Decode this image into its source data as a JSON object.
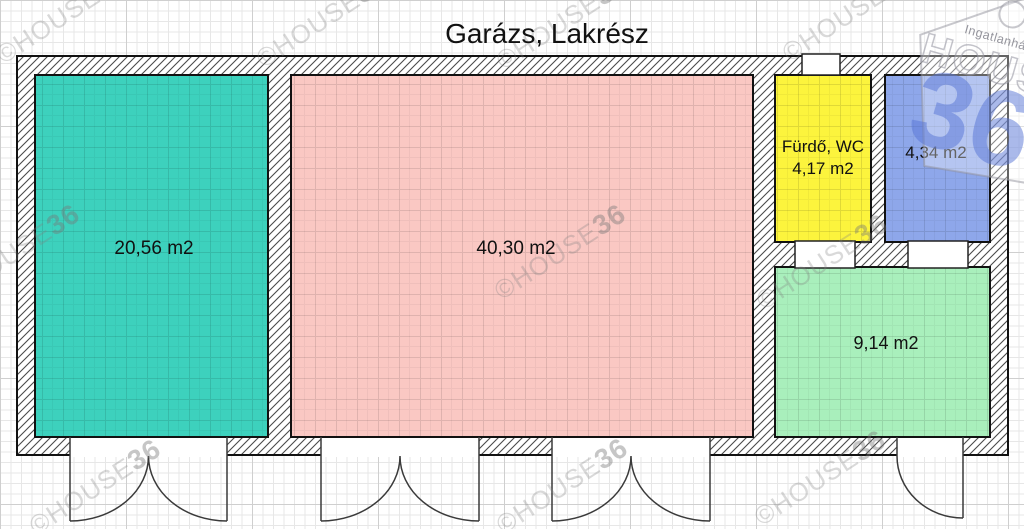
{
  "title": "Garázs, Lakrész",
  "watermark": {
    "prefix": "©HOUSE",
    "number": "36"
  },
  "logo": {
    "top_text": "Ingatlanhálózat",
    "brand": "HOUSE",
    "number": "36",
    "accent_color": "#5674d6"
  },
  "rooms": [
    {
      "id": "room-left-garage",
      "label": "20,56 m2",
      "color": "#3dd1bd"
    },
    {
      "id": "room-main",
      "label": "40,30 m2",
      "color": "#fac8c3"
    },
    {
      "id": "room-bathroom",
      "name": "Fürdő, WC",
      "label": "4,17 m2",
      "color": "#fcf43d"
    },
    {
      "id": "room-blue",
      "label": "4,34 m2",
      "color": "#8ea7ea"
    },
    {
      "id": "room-green",
      "label": "9,14 m2",
      "color": "#a9efbc"
    }
  ]
}
